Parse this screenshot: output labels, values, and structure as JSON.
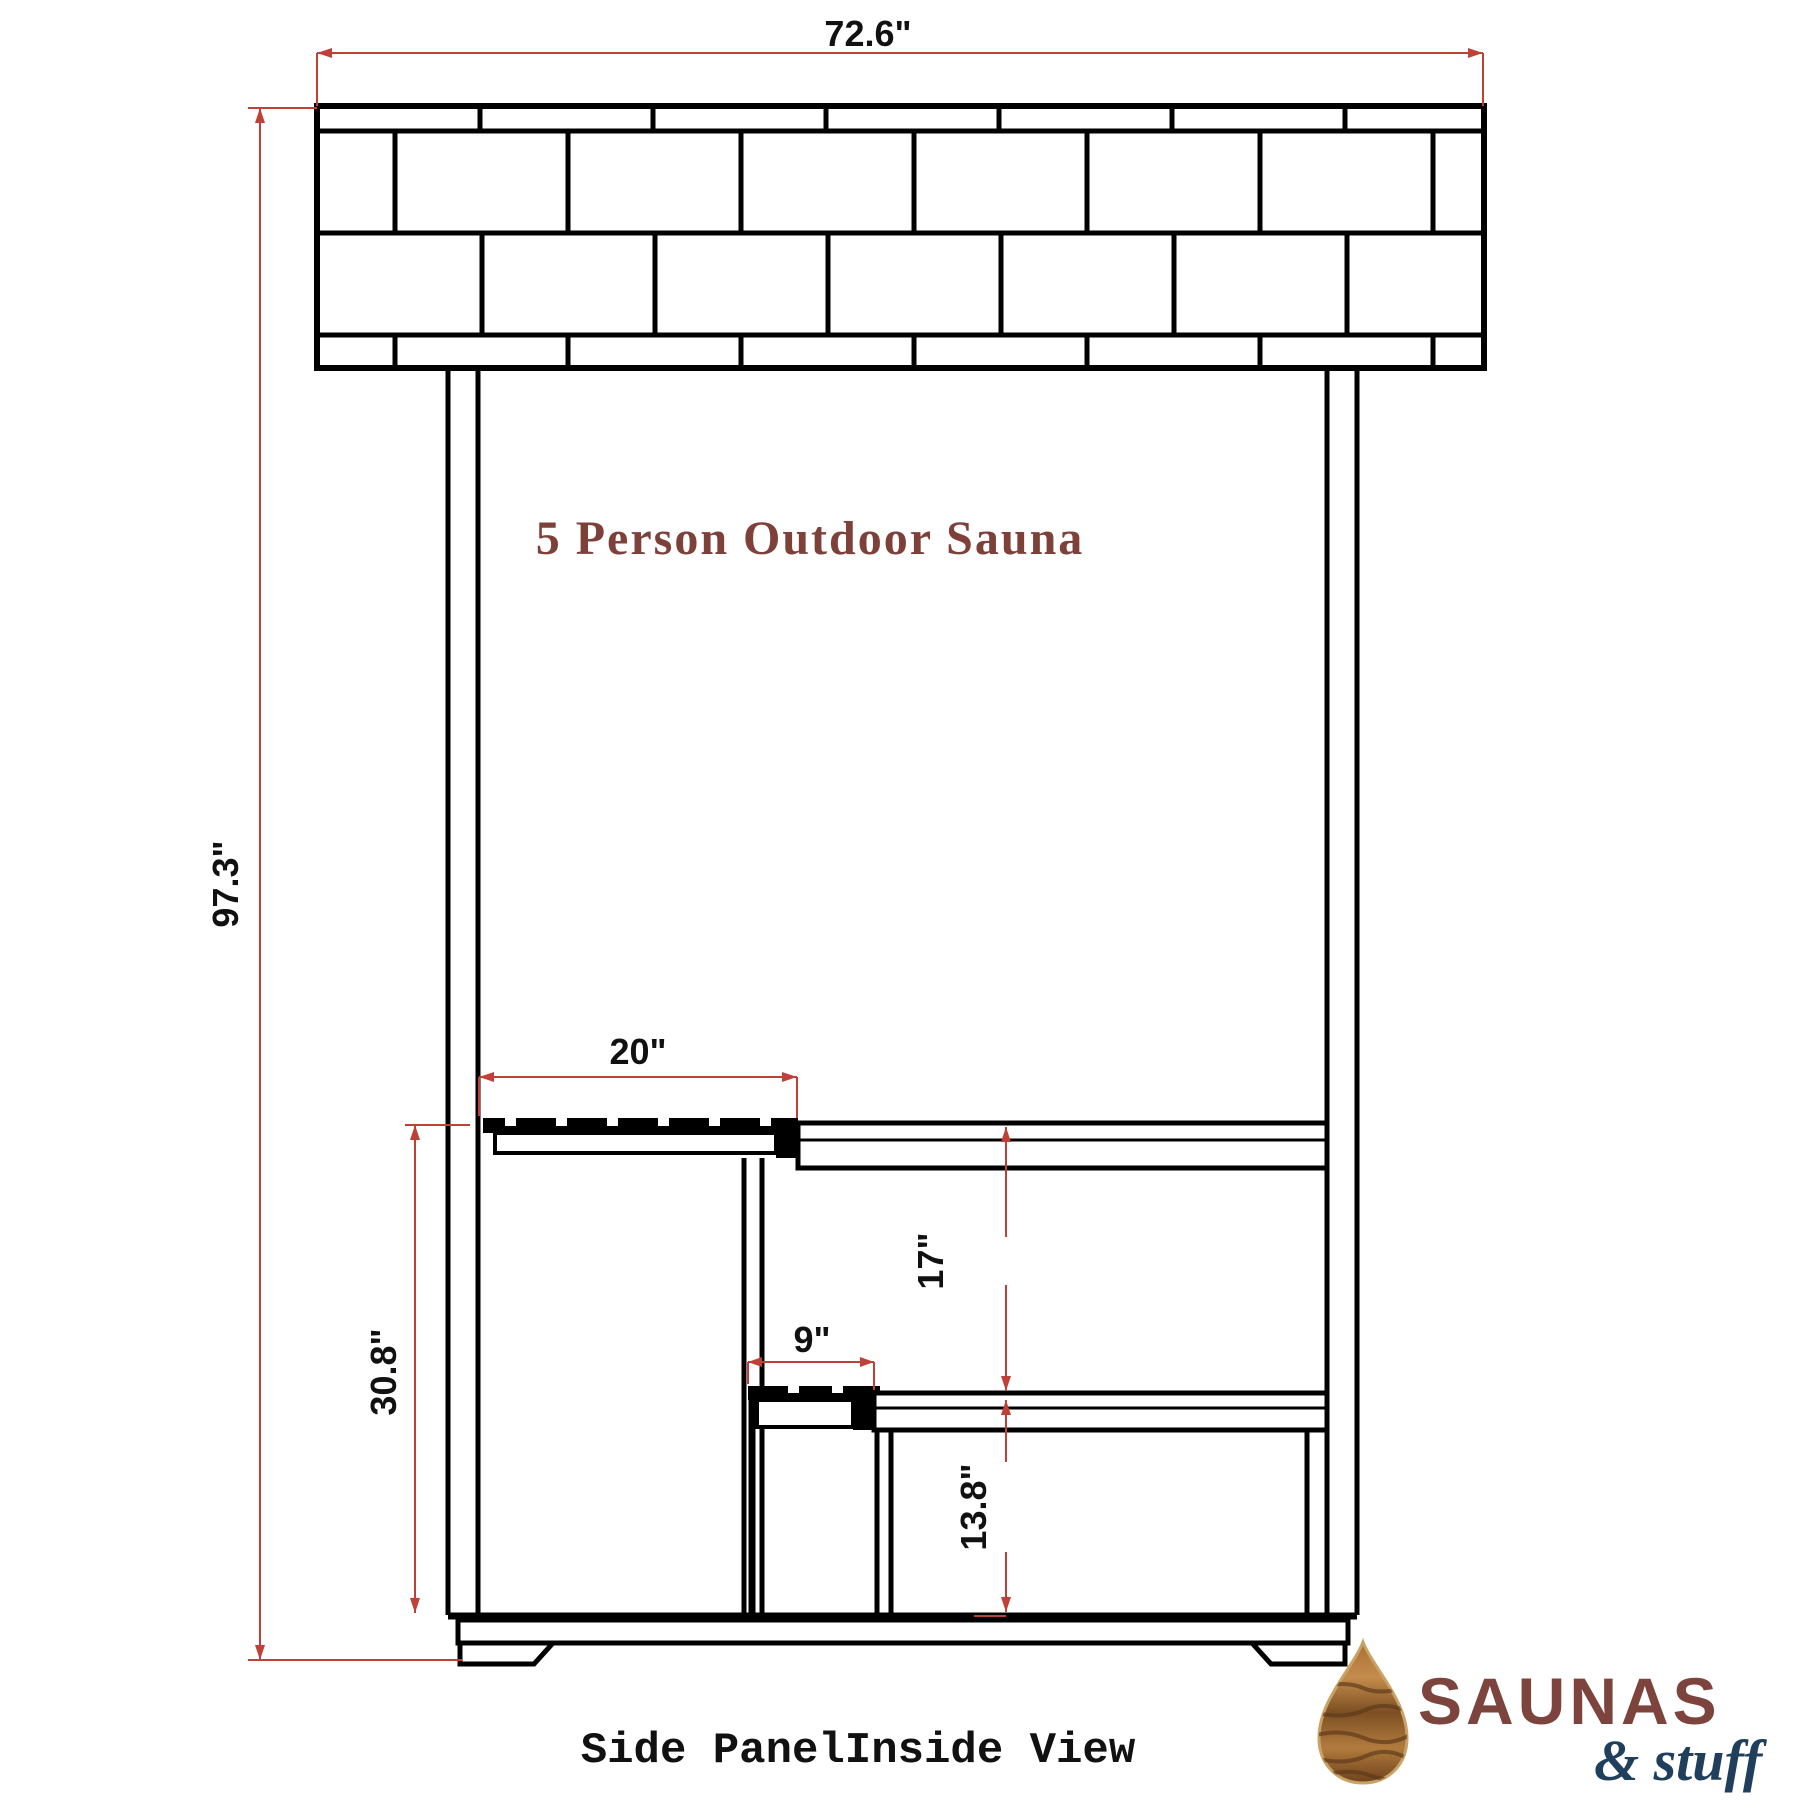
{
  "title": {
    "text": "5 Person Outdoor Sauna"
  },
  "caption": {
    "text": "Side PanelInside View"
  },
  "view_name": "side-panel-inside-view",
  "dimensions": {
    "overall_width": "72.6\"",
    "overall_height": "97.3\"",
    "upper_bench_depth": "20\"",
    "upper_bench_height": "30.8\"",
    "step_depth": "9\"",
    "bench_to_step_gap": "17\"",
    "step_height": "13.8\""
  },
  "logo": {
    "brand": "SAUNAS",
    "suffix": "& stuff",
    "mark": "wood-drop-icon"
  },
  "colors": {
    "dimension-red": "#c04038",
    "title-maroon": "#7e413a",
    "logo-brown": "#7c443c",
    "logo-navy": "#1f3f5c",
    "drawing-black": "#000000"
  }
}
